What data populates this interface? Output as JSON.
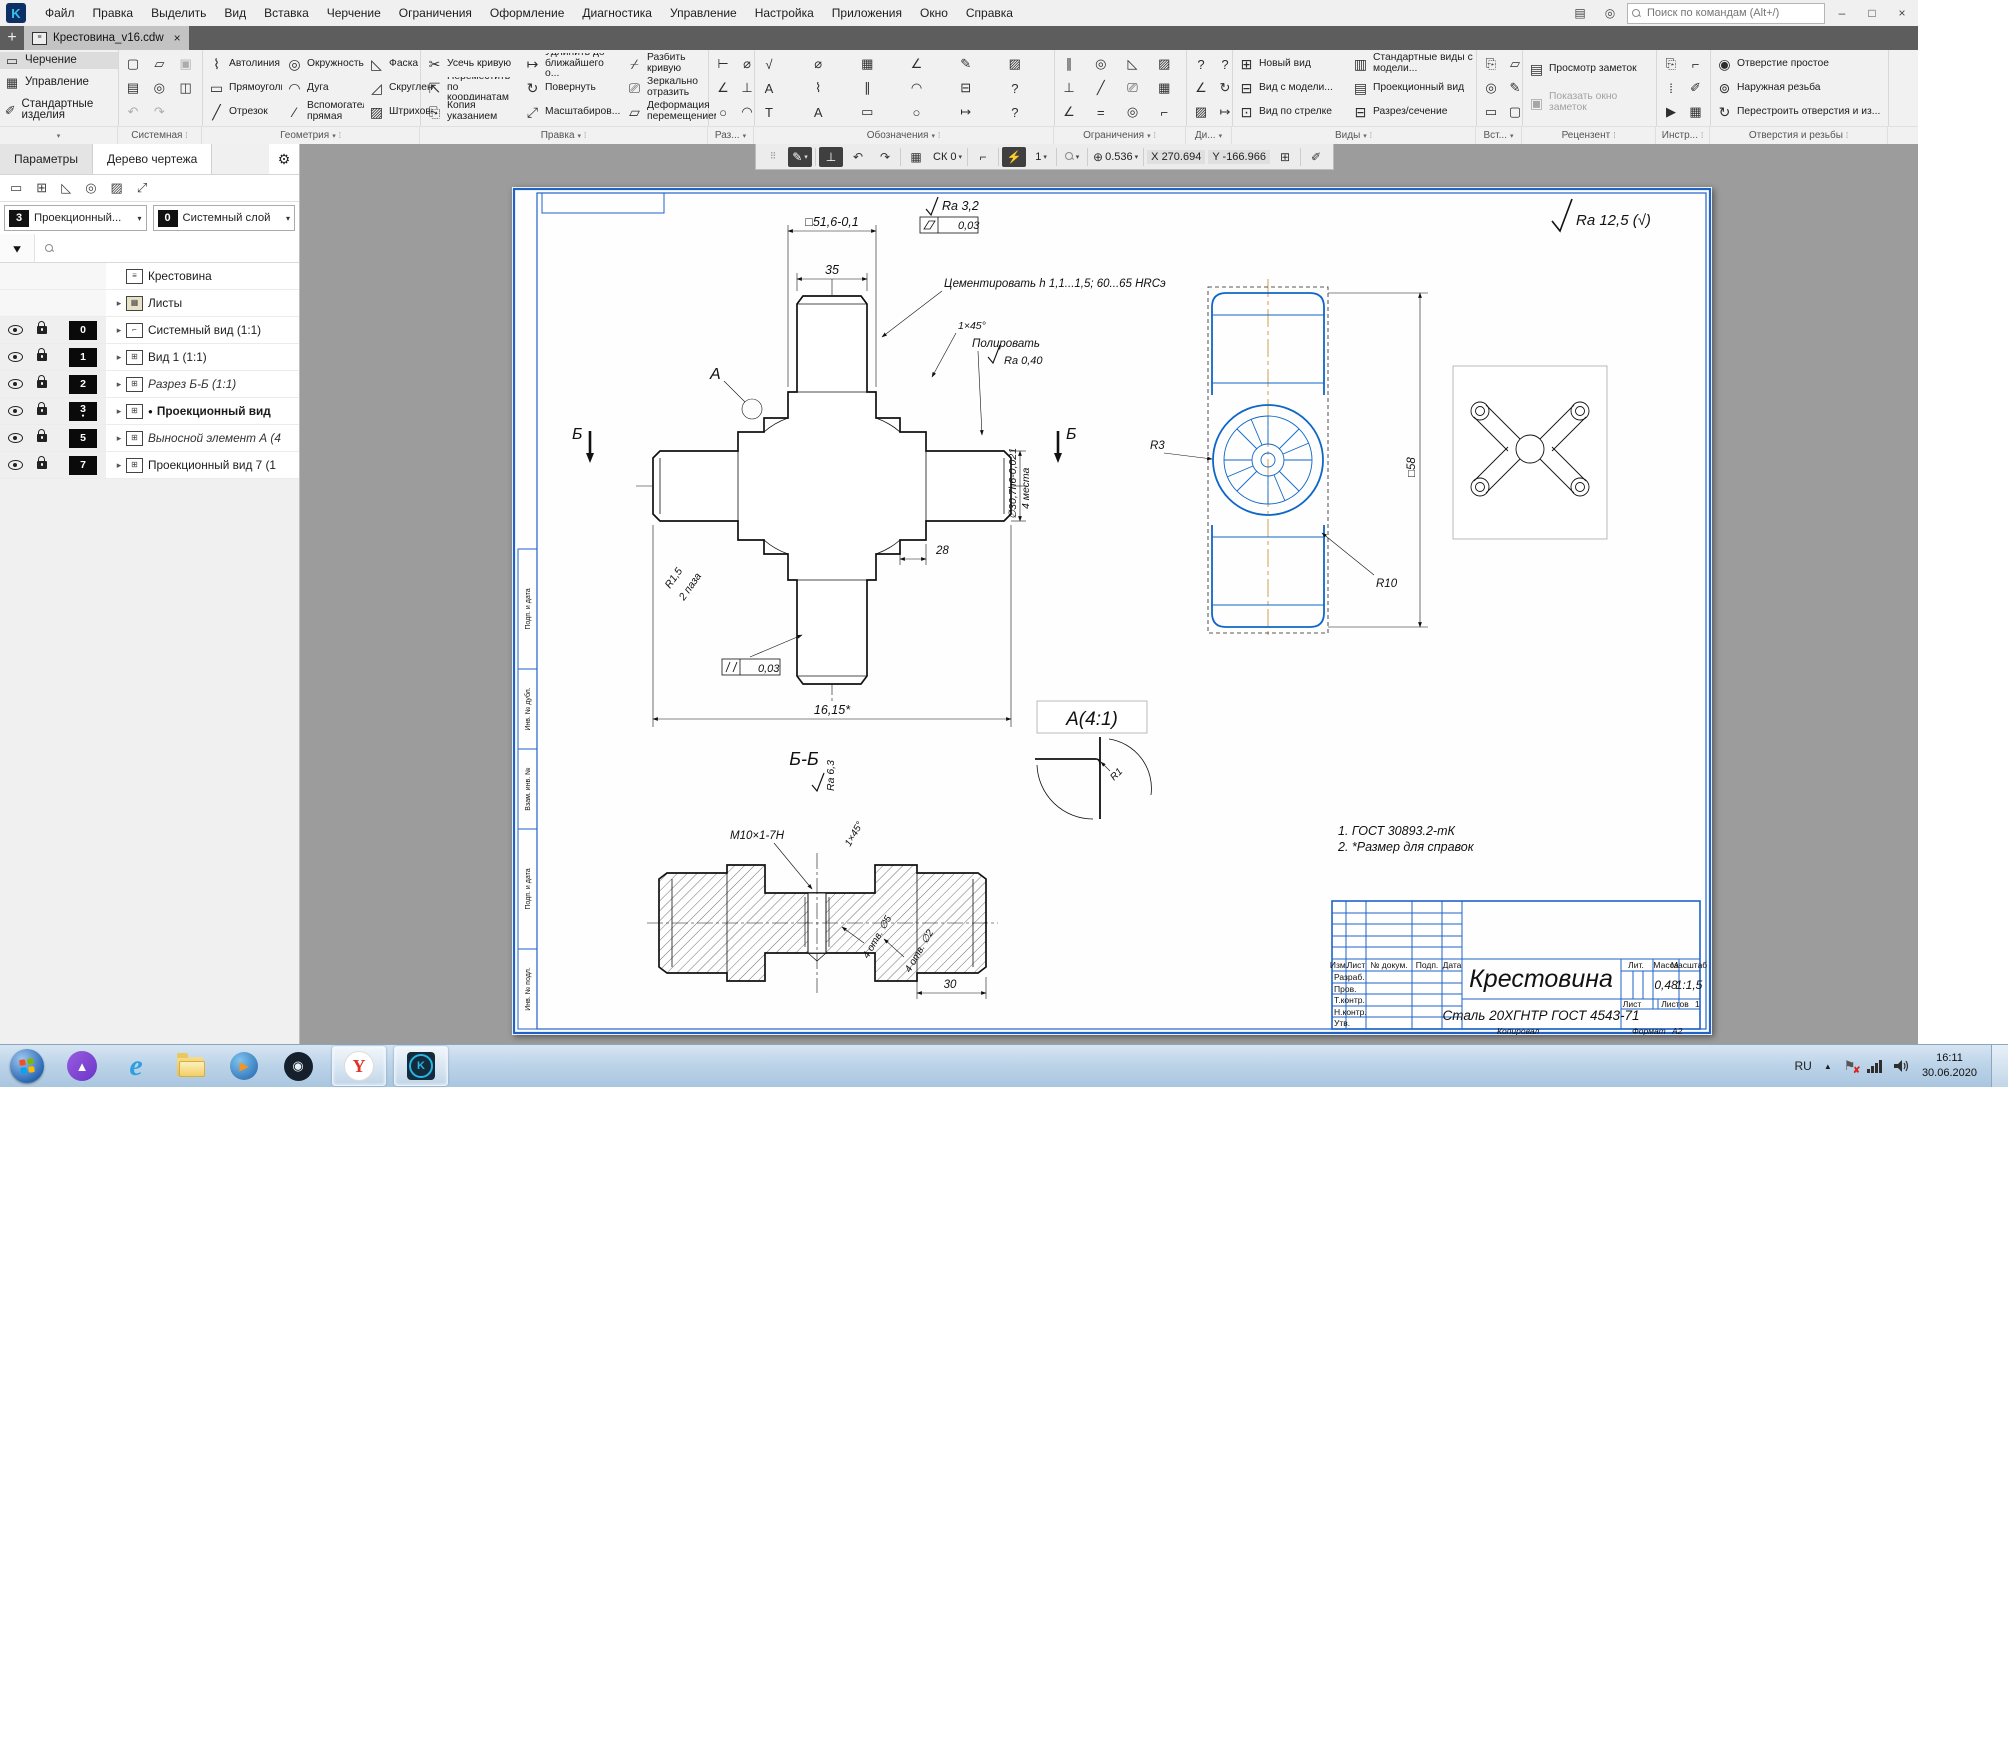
{
  "icons": {
    "plus": "+",
    "close": "×",
    "minimize": "–",
    "maximize": "□",
    "dropdown": "▾",
    "more": "⁞",
    "expand": "▸",
    "gear": "⚙",
    "funnel": "▼",
    "grip": "⠿",
    "doc": "≡",
    "new": "▢",
    "open": "▱",
    "save": "▣",
    "print": "▤",
    "preview": "◎",
    "saveas": "◫",
    "undo": "↶",
    "redo": "↷",
    "autoline": "⌇",
    "rect": "▭",
    "segment": "╱",
    "circle": "◎",
    "arc": "◠",
    "auxline": "⁄",
    "chamfer": "◺",
    "fillet": "◿",
    "hatch": "▨",
    "trim": "✂",
    "move": "⇱",
    "copy": "⎘",
    "extend": "↦",
    "rotate": "↻",
    "scale": "⤢",
    "split": "⌿",
    "mirror": "⎚",
    "deform": "▱",
    "dim1": "⊢",
    "dim2": "∥",
    "dim3": "⊥",
    "dim4": "○",
    "txtA": "А",
    "txtT": "Т",
    "tbl": "▦",
    "bolt": "⌀",
    "angle": "∠",
    "con1": "╱",
    "con2": "∠",
    "con3": "⊥",
    "con4": "◎",
    "q1": "?",
    "newview": "⊞",
    "viewmodel": "⊟",
    "viewarrow": "⊡",
    "stdviews": "▥",
    "projview": "▤",
    "section": "⊟",
    "rev1": "▤",
    "rev2": "▣",
    "hole": "◉",
    "thread": "⊚",
    "rebuild": "↻",
    "pencil": "✎",
    "pen": "✐",
    "grid": "▦",
    "corner": "⌐",
    "snap": "⚡",
    "zoomglass": "⊕",
    "alice": "▲",
    "wmplay": "▶",
    "steam": "◉",
    "yandex": "Y",
    "kompas": "K",
    "ie": "e",
    "note_star": "●"
  },
  "menu": {
    "items": [
      "Файл",
      "Правка",
      "Выделить",
      "Вид",
      "Вставка",
      "Черчение",
      "Ограничения",
      "Оформление",
      "Диагностика",
      "Управление",
      "Настройка",
      "Приложения",
      "Окно",
      "Справка"
    ],
    "search_placeholder": "Поиск по командам (Alt+/)"
  },
  "tab": {
    "title": "Крестовина_v16.cdw"
  },
  "ribbon": {
    "modes": [
      "Черчение",
      "Управление",
      "Стандартные изделия"
    ],
    "geometry": [
      "Автолиния",
      "Прямоугольник",
      "Отрезок",
      "Окружность",
      "Дуга",
      "Вспомогатель... прямая",
      "Фаска",
      "Скругление",
      "Штриховка"
    ],
    "edit": [
      "Усечь кривую",
      "Переместить по координатам",
      "Копия указанием",
      "Удлинить до ближайшего о...",
      "Повернуть",
      "Масштабиров...",
      "Разбить кривую",
      "Зеркально отразить",
      "Деформация перемещением"
    ],
    "views": [
      "Новый вид",
      "Вид с модели...",
      "Вид по стрелке",
      "Стандартные виды с модели...",
      "Проекционный вид",
      "Разрез/сечение"
    ],
    "review": [
      "Просмотр заметок",
      "Показать окно заметок"
    ],
    "holes": [
      "Отверстие простое",
      "Наружная резьба",
      "Перестроить отверстия и из..."
    ],
    "group_labels": [
      "Системная",
      "Геометрия",
      "Правка",
      "Раз...",
      "Обозначения",
      "Ограничения",
      "Ди...",
      "Виды",
      "Вст...",
      "Рецензент",
      "Инстр...",
      "Отверстия и резьбы"
    ]
  },
  "quickbar": {
    "sk": "СК 0",
    "step": "1",
    "zoom": "0.536",
    "x_label": "X",
    "x_value": "270.694",
    "y_label": "Y",
    "y_value": "-166.966"
  },
  "panel": {
    "tabs": [
      "Параметры",
      "Дерево чертежа"
    ],
    "combos": [
      {
        "badge": "3",
        "label": "Проекционный..."
      },
      {
        "badge": "0",
        "label": "Системный слой"
      }
    ],
    "tree": [
      {
        "label": "Крестовина"
      },
      {
        "label": "Листы"
      },
      {
        "badge": "0",
        "label": "Системный вид (1:1)"
      },
      {
        "badge": "1",
        "label": "Вид 1 (1:1)"
      },
      {
        "badge": "2",
        "label": "Разрез Б-Б (1:1)"
      },
      {
        "badge": "3",
        "label": "Проекционный вид",
        "bullet": "●"
      },
      {
        "badge": "5",
        "label": "Выносной элемент А (4"
      },
      {
        "badge": "7",
        "label": "Проекционный вид 7 (1"
      }
    ]
  },
  "drawing": {
    "corner_ra": "Ra 12,5 (√)",
    "main": {
      "dim_width": "□51,6-0,1",
      "dim_35": "35",
      "ra": "Ra 3,2",
      "tol1": "0,03",
      "note": "Цементировать h 1,1...1,5; 60...65 HRCэ",
      "chamfer": "1×45°",
      "polish": "Полировать",
      "ra2": "Ra 0,40",
      "view_a": "А",
      "sec_b1": "Б",
      "sec_b2": "Б",
      "r15": "R1,5",
      "slots": "2 паза",
      "dim_28": "28",
      "dim_shaft": "∅30,7h6-0,021",
      "places": "4 места",
      "tol2": "0,03",
      "dim_total": "16,15*"
    },
    "section": {
      "title": "Б-Б",
      "ra": "Ra 6,3",
      "thread": "M10×1-7H",
      "chamfer": "1×45°",
      "holes1": "4 отв. ∅5",
      "holes2": "4 отв. ∅2",
      "dim_30": "30"
    },
    "side": {
      "r3": "R3",
      "r10": "R10",
      "dim_58": "□58"
    },
    "detail": {
      "title": "А(4:1)",
      "r1": "R1"
    },
    "notes": [
      "1. ГОСТ 30893.2-тК",
      "2. *Размер для справок"
    ],
    "stamp": {
      "name": "Крестовина",
      "material": "Сталь 20ХГНТР ГОСТ 4543-71",
      "lit_label": "Лит.",
      "mass_label": "Масса",
      "mass": "0,48",
      "scale_label": "Масштаб",
      "scale": "1:1,5",
      "sheet_label": "Лист",
      "sheets_label": "Листов",
      "sheets": "1",
      "header": [
        "Изм.",
        "Лист",
        "№ докум.",
        "Подп.",
        "Дата"
      ],
      "signers": [
        "Разраб.",
        "Пров.",
        "Т.контр.",
        "Н.контр.",
        "Утв."
      ],
      "copy": "Копировал",
      "format_label": "Формат",
      "format": "А2"
    },
    "side_strips": [
      "Инв. № подл.",
      "Подп. и дата",
      "Взам. инв. №",
      "Инв. № дубл.",
      "Подп. и дата"
    ]
  },
  "taskbar": {
    "lang": "RU",
    "time": "16:11",
    "date": "30.06.2020"
  }
}
